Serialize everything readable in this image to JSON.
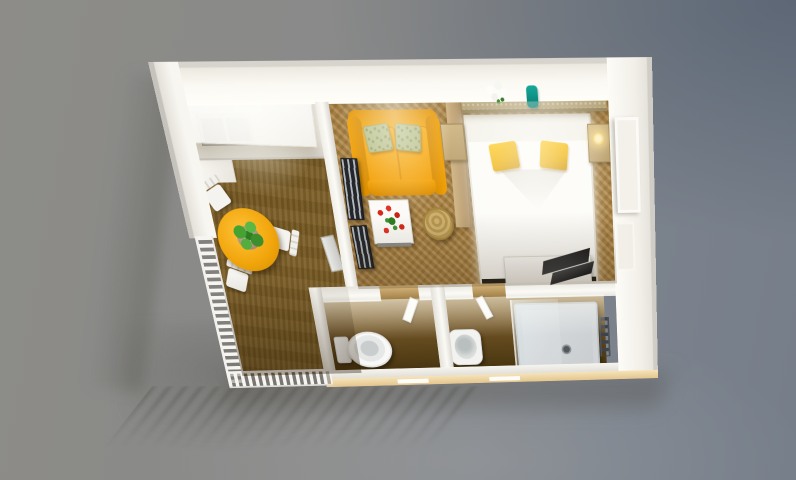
{
  "scene": {
    "type": "3d-home-design-render",
    "visible_text": "none",
    "description": "Overhead 3D rendering of a furnished studio apartment with kitchen-dining room, living-bedroom, WC and shower room, and a balcony railing at lower left"
  },
  "labels": {
    "viewport": "3D rendered floor plan of a studio apartment viewed from above",
    "kitchen_counter": "Kitchen counter with twin dark sink basins",
    "kitchen_upper_cabinet": "Kitchen upper cabinets",
    "kitchen_tall_cabinet": "Tall kitchen cabinet",
    "dining_table": "Round orange dining table",
    "dining_plant": "Green potted plant on dining table",
    "dining_chair": "White dining chair",
    "sofa": "Orange two-seat sofa with green cushions",
    "coffee_table": "White coffee table with red tulips",
    "pouf": "Round rattan pouf",
    "room_divider": "Wooden room divider screen",
    "drying_rack": "Folded drying rack against partition wall",
    "step_stool": "Folded step stool",
    "wall_shelf": "Wall shelf above sofa",
    "headboard_shelf": "Headboard shelf with white flowers and teal vase",
    "flower_bouquet": "White flower bouquet",
    "teal_vase": "Teal vase",
    "bed": "White double bed with two yellow pillows",
    "nightstand": "Bedside table",
    "bedside_lamp": "Glowing bedside lamp",
    "desk": "White desk",
    "laptop": "Open black laptop",
    "wall_picture": "Framed picture on right wall",
    "toilet": "Toilet in WC room",
    "washbasin": "Round washbasin",
    "shower": "Square shower tray with glass panel",
    "towel_radiator": "Towel radiator",
    "balcony_railing": "White balcony railing",
    "fascia": "Beige exterior slab with window slits",
    "wc_door": "Open WC door",
    "bath_door": "Open bathroom door"
  },
  "rooms": [
    {
      "name": "kitchen-dining",
      "floor": "brown carpet"
    },
    {
      "name": "living-bedroom",
      "floor": "golden parquet"
    },
    {
      "name": "wc",
      "floor": "dark wood"
    },
    {
      "name": "shower-room",
      "floor": "dark wood"
    }
  ],
  "palette": {
    "bg-warm": "#8d8c88",
    "bg-cool": "#7b828c",
    "wall-face": "#fbf9f3",
    "carpet": "#7a5c24",
    "parquet": "#aa8140",
    "bath-floor": "#46340f",
    "sofa": "#f4a50b",
    "pillow-green": "#b9c08c",
    "table-orange": "#f2a70d",
    "chair-white": "#f4f3ef",
    "bed-white": "#fcfbf7",
    "bed-base": "#24221d",
    "pillow-yellow": "#eeb004",
    "shelf-tan": "#b7a67b",
    "nightstand": "#b99f6e",
    "vase-teal": "#0b7c72",
    "divider-wood": "#b2946a",
    "rack-dark": "#23272c",
    "fixture-white": "#fafaf8",
    "shower-tray": "#dadddf",
    "radiator": "#3d4348",
    "fascia": "#e4c58f",
    "laptop": "#0d0e10"
  }
}
